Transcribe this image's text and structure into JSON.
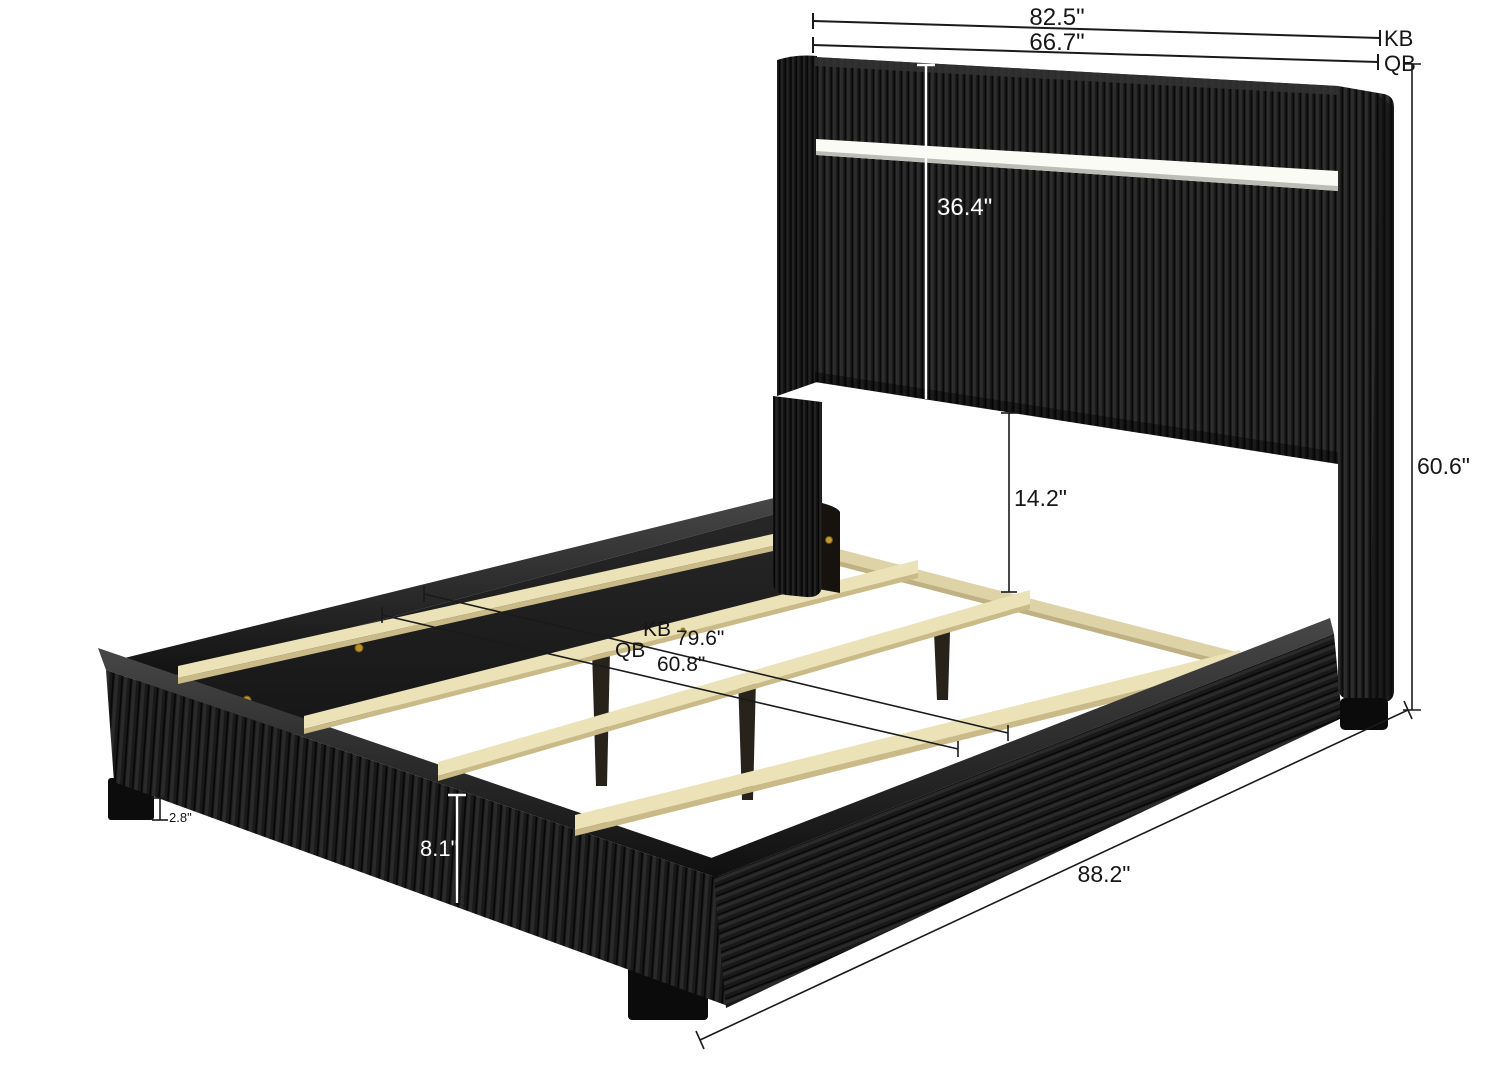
{
  "page": {
    "title": "Upholstered Bed Frame Dimension Diagram",
    "background": "#ffffff"
  },
  "dimensions": {
    "king_width": {
      "value": "82.5\"",
      "tag": "KB"
    },
    "queen_width": {
      "value": "66.7\"",
      "tag": "QB"
    },
    "headboard_panel_height": {
      "value": "36.4\""
    },
    "headboard_to_slat_clearance": {
      "value": "14.2\""
    },
    "headboard_total_height": {
      "value": "60.6\""
    },
    "king_slat_length": {
      "tag": "KB",
      "value": "79.6\""
    },
    "queen_slat_length": {
      "tag": "QB",
      "value": "60.8\""
    },
    "total_length": {
      "value": "88.2\""
    },
    "side_rail_height": {
      "value": "8.1\""
    },
    "leg_height": {
      "value": "2.8\""
    }
  },
  "materials": {
    "fabric_color": "#1c1c1c",
    "wood_color": "#ece2b8",
    "led_strip_color": "#ffffff",
    "dimension_line_color": "#1a1a1a"
  }
}
